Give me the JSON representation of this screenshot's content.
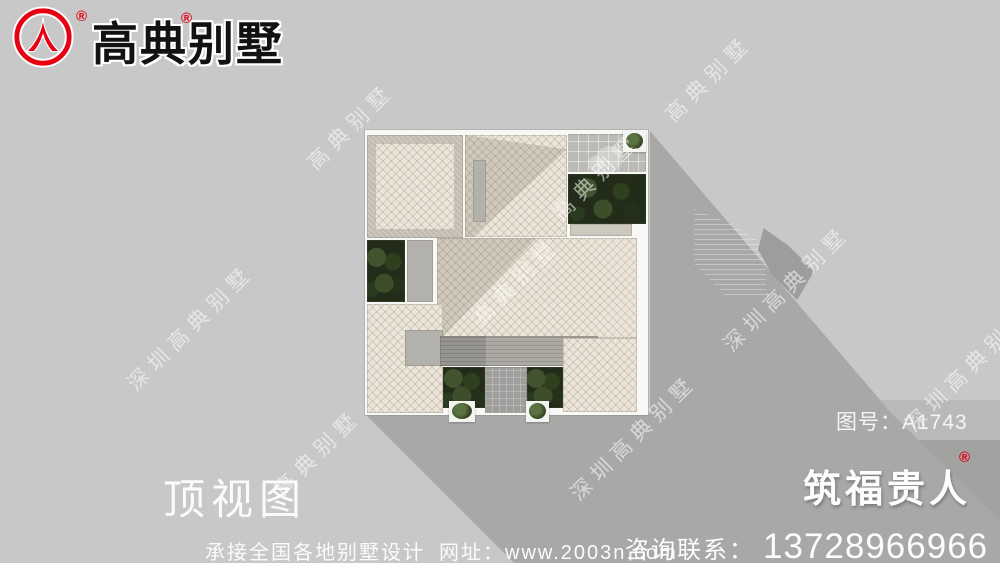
{
  "brand": {
    "name": "高典别墅",
    "registered_mark": "®"
  },
  "secondary_brand": {
    "name": "筑福贵人",
    "registered_mark": "®"
  },
  "view_label": "顶视图",
  "drawing": {
    "label": "图号：",
    "number": "A1743"
  },
  "footer": {
    "service": "承接全国各地别墅设计",
    "website_label": "网址：",
    "website": "www.2003n.com",
    "contact_label": "咨询联系：",
    "phone": "13728966966"
  },
  "watermarks": {
    "short": "高典别墅",
    "long": "深圳高典别墅"
  },
  "colors": {
    "brand_red": "#e60012",
    "background_gray": "#c7c8c7",
    "shadow_gray": "#a8a8a7",
    "roof_tile_cream": "#ece6da",
    "plant_green": "#222c19"
  }
}
